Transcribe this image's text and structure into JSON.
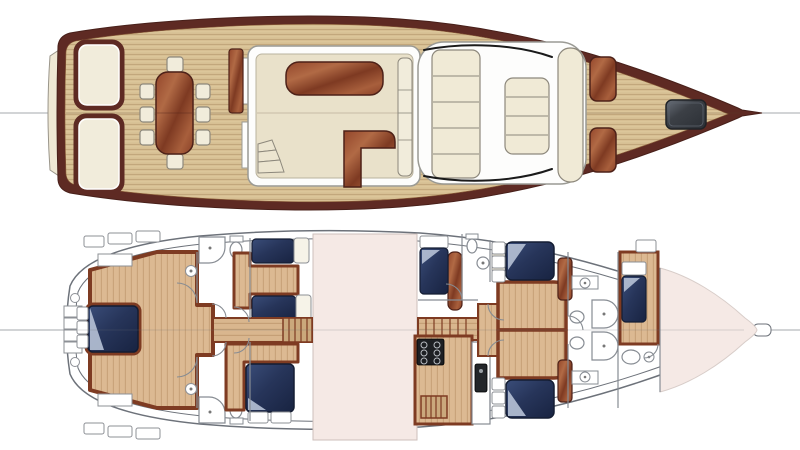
{
  "diagram": {
    "kind": "yacht-two-deck-floor-plan",
    "orientation": "bow-right",
    "views": [
      {
        "id": "main-deck",
        "label": "Main deck plan",
        "features": [
          "swim platform",
          "aft bench seats",
          "cockpit dining table",
          "eight dining chairs",
          "mahogany sideboard",
          "saloon with coffee table",
          "L-shaped counter",
          "companionway steps",
          "forward settee",
          "coachroof sun pads",
          "handrails",
          "two mahogany deck hatches",
          "grey anchor hatch",
          "bowsprit"
        ]
      },
      {
        "id": "lower-deck",
        "label": "Lower deck plan",
        "features": [
          "transom steps",
          "full-beam master cabin with double berth",
          "master vanities",
          "two en-suite shower rooms",
          "twin-berth guest cabin",
          "double guest cabin",
          "aft companionway stairs",
          "engine room",
          "galley with six-burner stove and sink",
          "single guest cabin",
          "day head",
          "two mirrored double guest cabins",
          "forward shower rooms with twin basins",
          "crew cabin with single berth and head",
          "forepeak locker",
          "bowsprit"
        ]
      }
    ]
  },
  "palette": {
    "page_bg": "#ffffff",
    "hull_maroon": "#5e2a23",
    "hull_maroon_edge": "#48201a",
    "deck_teak": "#d7bf93",
    "cream_upholstery": "#f1ecdb",
    "cream_edge": "#8d887c",
    "saloon_floor": "#e9e1ca",
    "wall_white": "#fdfdfc",
    "wall_outline": "#9a9a94",
    "mahogany_edge": "#4d2118",
    "floor_border": "#7e3b22",
    "berth_navy_edge": "#141d33",
    "berth_fold": "#b7c2d6",
    "engine_room_pink": "#f5e9e5",
    "pink_edge": "#cdbfbb",
    "lower_hull_line": "#6d727a",
    "fixture_outline": "#878c93",
    "fixture_white": "#ffffff",
    "stove_black": "#1d1f23",
    "hatch_grey_edge": "#202327",
    "centerline_grey": "#a6a9ad",
    "stair_wood": "#caa87c"
  }
}
